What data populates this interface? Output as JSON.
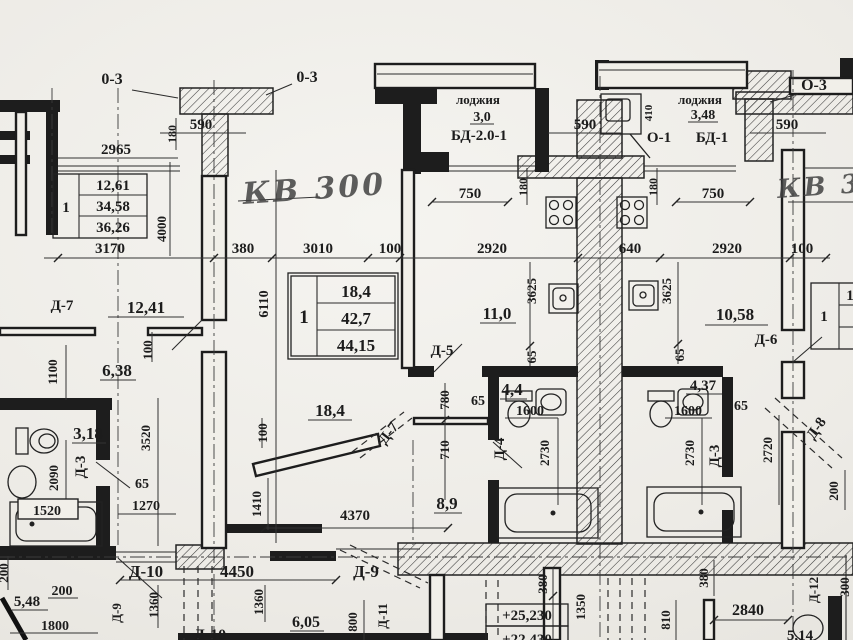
{
  "labels": {
    "axis_o3_left": "0-3",
    "axis_o3_center": "0-3",
    "axis_o3_right": "О-3",
    "kv_300": "КВ 300",
    "kv_3": "КВ 3",
    "loggia_c_name": "лоджия",
    "loggia_c_area": "3,0",
    "loggia_c_door": "БД-2.0-1",
    "loggia_r_name": "лоджия",
    "loggia_r_area": "3,48",
    "loggia_r_axis": "О-1",
    "loggia_r_door": "БД-1",
    "dim_590_l": "590",
    "dim_590_c": "590",
    "dim_590_r": "590",
    "dim_2965": "2965",
    "dim_180_l": "180",
    "dim_180_c": "180",
    "dim_180_r": "180",
    "dim_750_l": "750",
    "dim_750_r": "750",
    "dim_4000": "4000",
    "dim_410": "410",
    "dim_3170": "3170",
    "dim_380_top": "380",
    "dim_3010": "3010",
    "dim_100_top_l": "100",
    "dim_2920_l": "2920",
    "dim_640": "640",
    "dim_2920_r": "2920",
    "dim_100_top_r": "100",
    "door_d7_l": "Д-7",
    "area_12_41": "12,41",
    "dim_100_v1": "100",
    "dim_6110": "6110",
    "dim_1100": "1100",
    "area_6_38": "6,38",
    "table_l_col": "1",
    "table_l_r1": "12,61",
    "table_l_r2": "34,58",
    "table_l_r3": "36,26",
    "table_c_col": "1",
    "table_c_r1": "18,4",
    "table_c_r2": "42,7",
    "table_c_r3": "44,15",
    "table_r_col": "1",
    "table_r_part": "1",
    "area_11_0": "11,0",
    "dim_3625_l": "3625",
    "dim_3625_r": "3625",
    "door_d5": "Д-5",
    "dim_65_v1": "65",
    "dim_65_v2": "65",
    "area_10_58": "10,58",
    "door_d6": "Д-6",
    "area_3_18": "3,18",
    "dim_3520": "3520",
    "dim_2090": "2090",
    "door_d3_l": "Д-3",
    "dim_1520": "1520",
    "dim_65_a": "65",
    "dim_1270": "1270",
    "area_18_4": "18,4",
    "door_d7_diag": "Д-7",
    "dim_100_v2": "100",
    "dim_780": "780",
    "dim_65_b": "65",
    "area_4_4": "4,4",
    "dim_1600_l": "1600",
    "dim_710": "710",
    "door_d4": "Д-4",
    "dim_2730_l": "2730",
    "dim_2730_r": "2730",
    "area_4_37": "4,37",
    "dim_1600_r": "1600",
    "dim_65_c": "65",
    "door_d3_r": "Д-3",
    "dim_2720": "2720",
    "door_d8": "Д-8",
    "dim_200_r": "200",
    "area_8_9": "8,9",
    "dim_1410": "1410",
    "dim_4370": "4370",
    "dim_200_bl_v": "200",
    "area_5_48": "5,48",
    "dim_200_bl": "200",
    "dim_1800": "1800",
    "door_d9_v": "Д-9",
    "dim_1360_a": "1360",
    "dim_1360_b": "1360",
    "door_d10": "Д-10",
    "dim_4450": "4450",
    "door_d9": "Д-9",
    "door_d10_b": "Д-10",
    "area_6_05": "6,05",
    "dim_800": "800",
    "door_d11": "Д-11",
    "dim_380_b1": "380",
    "dim_380_b2": "380",
    "dim_1350": "1350",
    "dim_810": "810",
    "elev_1": "+25,230",
    "elev_2": "+22,430",
    "dim_2840": "2840",
    "door_d12": "Д-12",
    "dim_300_r": "300",
    "area_5_14": "5,14"
  }
}
